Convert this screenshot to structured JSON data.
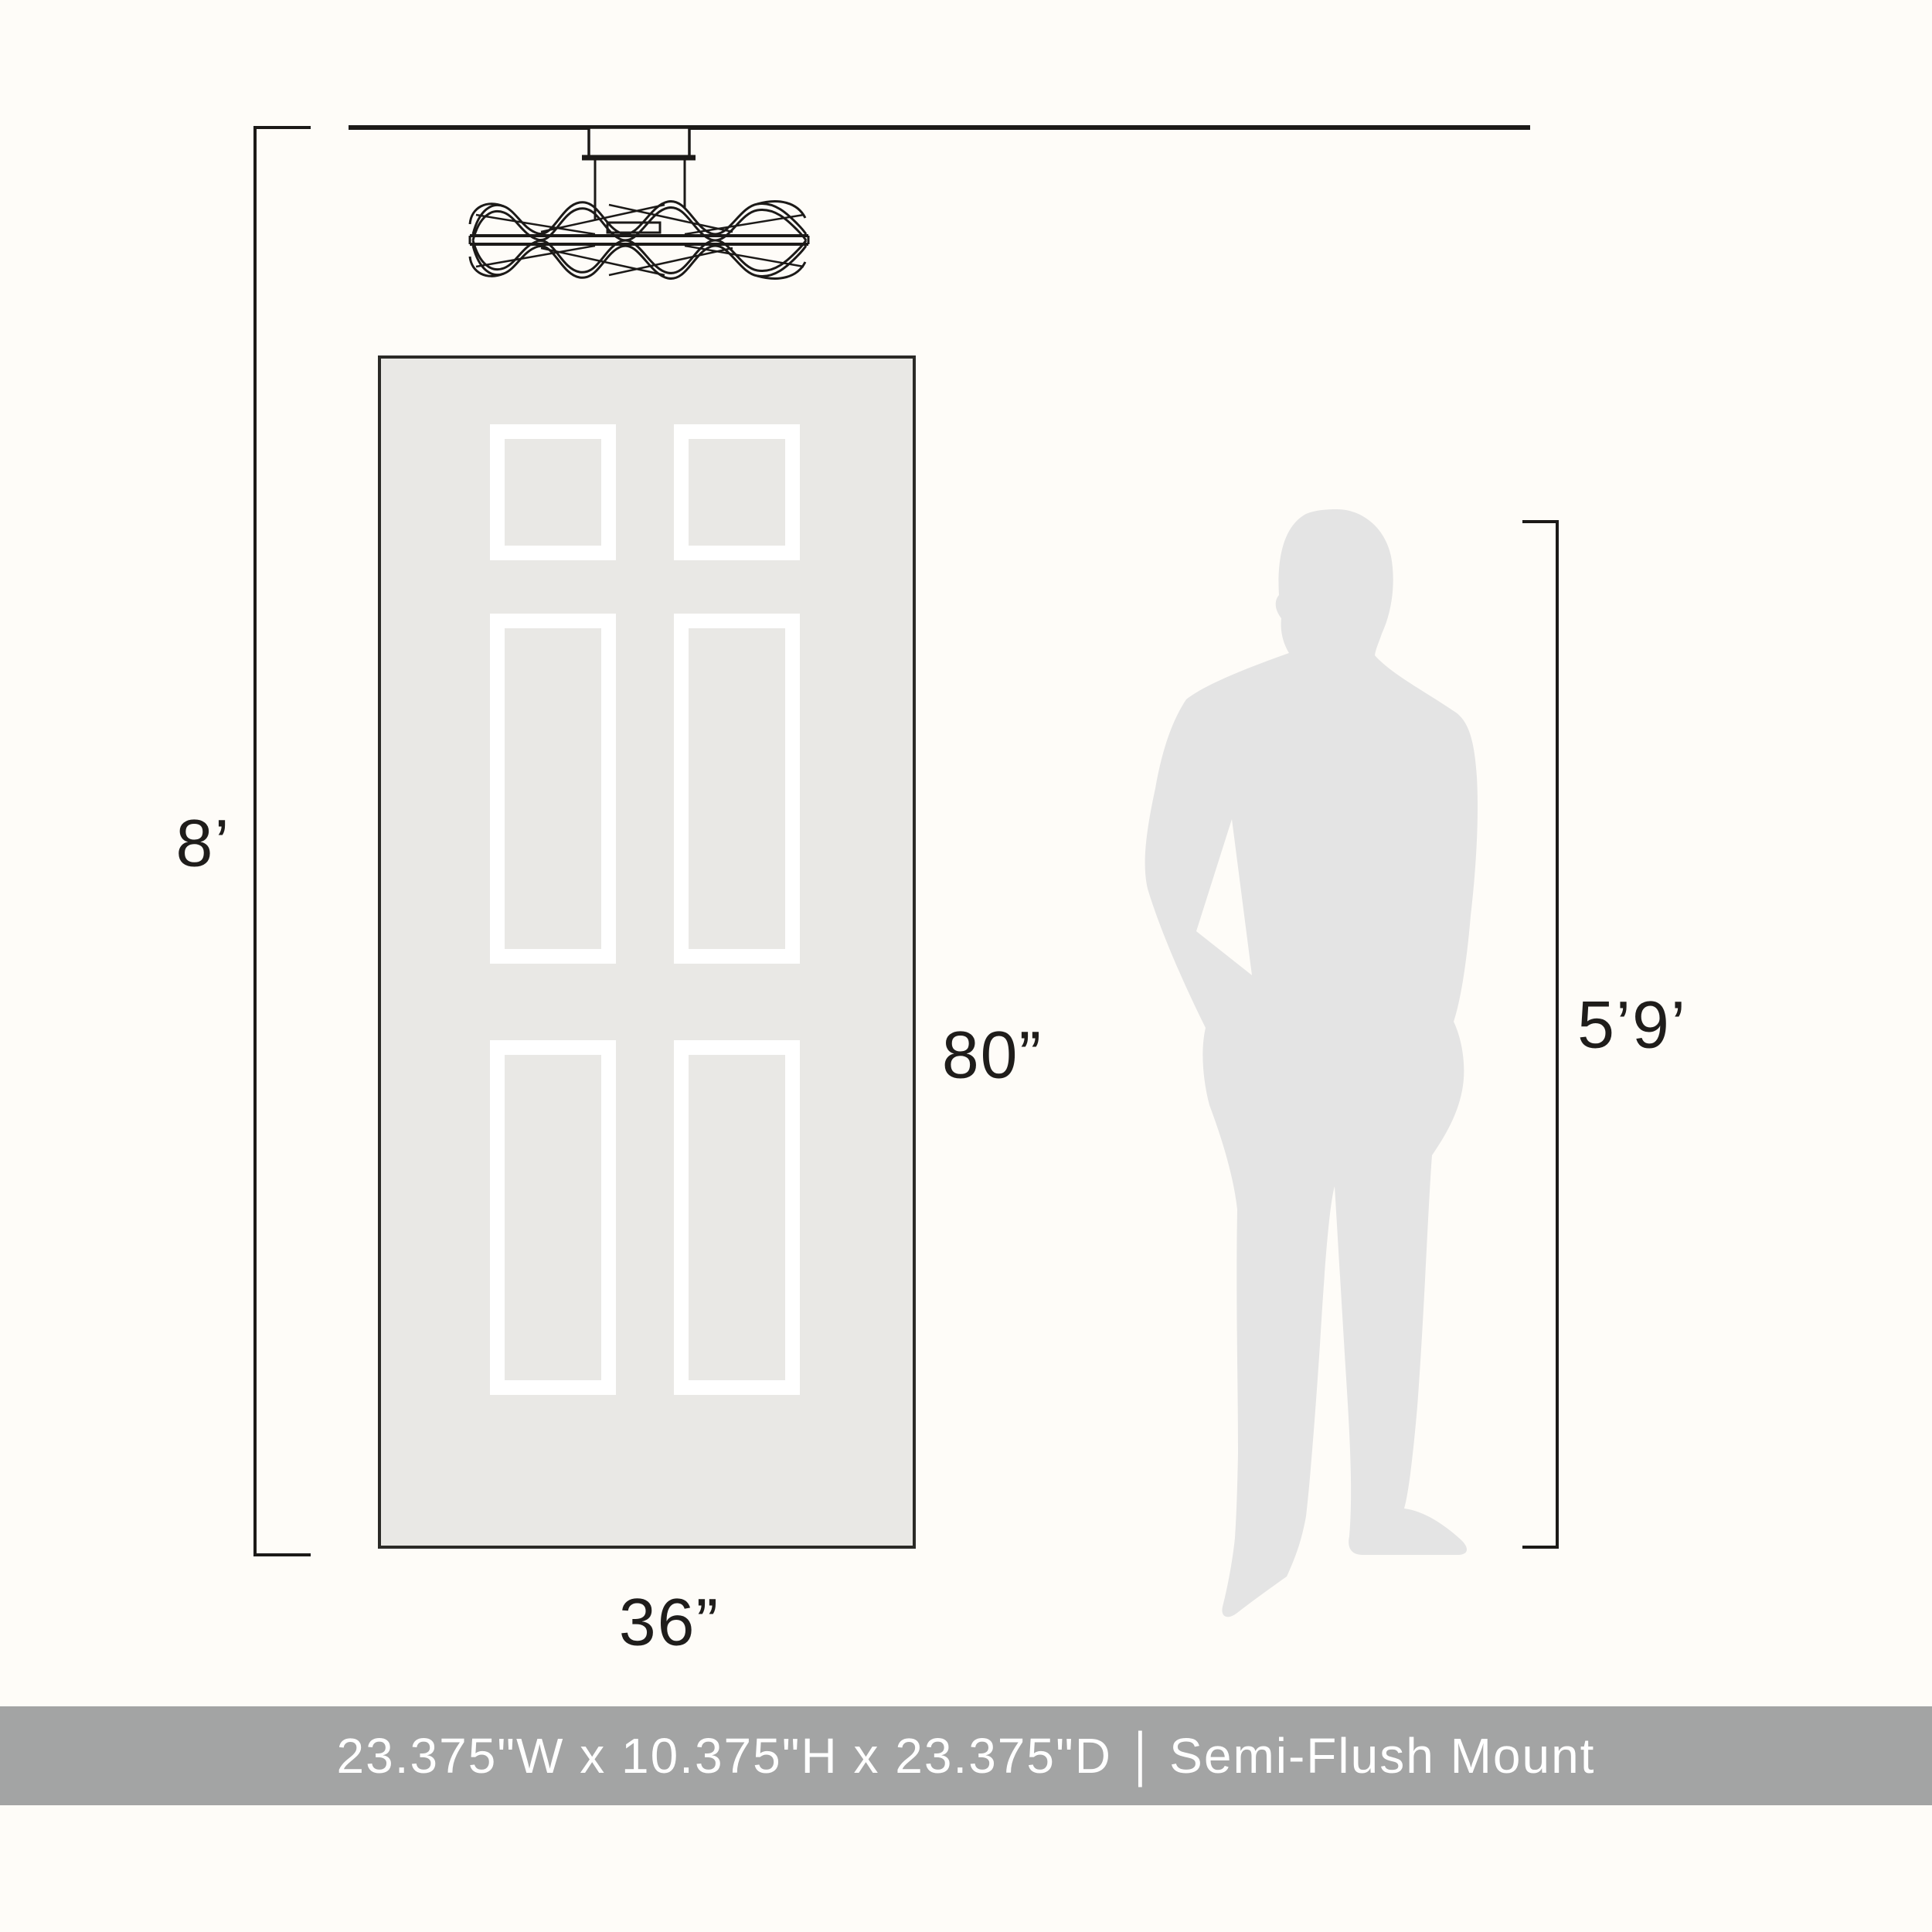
{
  "diagram": {
    "ceiling_height_label": "8’",
    "door_height_label": "80”",
    "door_width_label": "36”",
    "person_height_label": "5’9’",
    "fixture_name": "semi-flush-mount-ceiling-light",
    "banner": {
      "dimensions_text": "23.375\"W x 10.375\"H x 23.375\"D",
      "separator": "|",
      "product_type": "Semi-Flush Mount"
    }
  },
  "colors": {
    "background": "#fefcf8",
    "line": "#1c1a18",
    "door_fill": "#e9e8e5",
    "door_border": "#2b2a27",
    "panel_frame": "#ffffff",
    "person_fill": "#e4e4e4",
    "banner_bg": "#a3a4a4",
    "banner_text": "#ffffff",
    "label_text": "#1f1d1b"
  }
}
